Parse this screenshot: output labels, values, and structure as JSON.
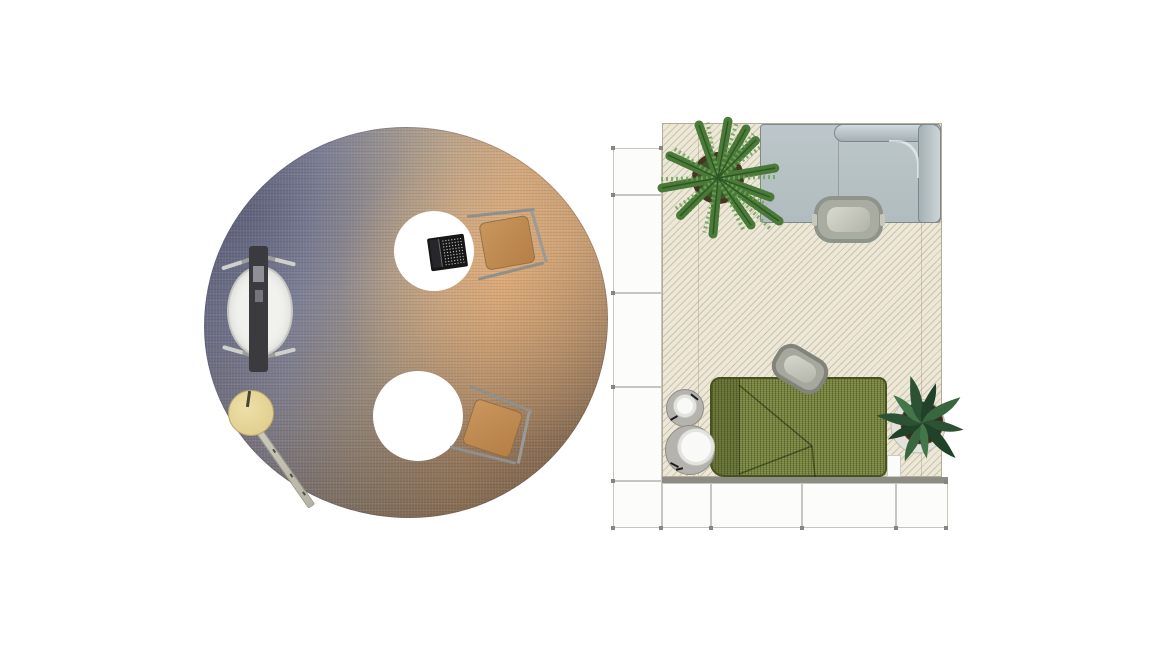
{
  "canvas": {
    "width": 1166,
    "height": 656,
    "background": "#ffffff"
  },
  "scene": {
    "title": "Top-down furniture space plan",
    "zones": [
      {
        "id": "lounge-circle",
        "label": "Round gradient rug lounge setting",
        "rug": {
          "shape": "round",
          "label": "Woven gradient area rug",
          "colors": {
            "slate_blue": "#6a6c83",
            "lavender_gray": "#8f91a4",
            "tan": "#c09a74",
            "orange": "#cda67e",
            "brown": "#6f6156"
          }
        },
        "items": [
          {
            "id": "lounge-chair",
            "label": "High-back lounge chair with privacy panel",
            "panel_color": "#3a3a3f",
            "body_color": "#f1f1ee"
          },
          {
            "id": "round-table-top",
            "label": "Round white table with laptop",
            "color": "#ffffff"
          },
          {
            "id": "laptop",
            "label": "Open laptop",
            "color": "#161616"
          },
          {
            "id": "chair-top",
            "label": "Caramel sled-base side chair",
            "seat_color": "#c29058"
          },
          {
            "id": "round-table-bottom",
            "label": "Round white table",
            "color": "#ffffff"
          },
          {
            "id": "chair-bottom",
            "label": "Caramel sled-base side chair",
            "seat_color": "#c29058"
          },
          {
            "id": "disc-stool",
            "label": "Wooden disc stool with leaning plank",
            "disc_color": "#e7d595",
            "plank_color": "#c8c6b6"
          }
        ]
      },
      {
        "id": "modular-room",
        "label": "Modular lounge room with storage cubes",
        "rug": {
          "shape": "rectangle",
          "label": "Cream diagonal-hatch rug",
          "color": "#ece7d7",
          "hatch_color": "#a69c7c"
        },
        "storage": {
          "label": "White modular storage cubes (left column and bottom row)",
          "cube_color": "#fcfcfa",
          "cap_color": "#8c8c84",
          "column_segments": 5,
          "row_segments": 4
        },
        "items": [
          {
            "id": "sofa-gray",
            "label": "Light gray L-shaped sectional sofa",
            "color": "#b7c2c5",
            "back_color": "#ccd5d7"
          },
          {
            "id": "ottoman-gray",
            "label": "Gray rounded ottoman",
            "color": "#a9aca0"
          },
          {
            "id": "sofa-green",
            "label": "Olive green knit corner sofa",
            "color": "#75813e"
          },
          {
            "id": "ottoman-green",
            "label": "Rotated gray-green ottoman",
            "color": "#a7a89d"
          },
          {
            "id": "side-table-small",
            "label": "Small round side table with cup",
            "color": "#b5b3ae"
          },
          {
            "id": "side-table-large",
            "label": "Round side table with tray",
            "color": "#b5b3ae"
          },
          {
            "id": "fern-plant",
            "label": "Potted fern (top left)",
            "foliage": "#4a7a38",
            "pot": "#453521"
          },
          {
            "id": "tropical-plant",
            "label": "Potted tropical plant (bottom right)",
            "foliage": "#2b5233",
            "pot": "#3a2c1c"
          }
        ]
      }
    ]
  },
  "palette": {
    "fern_green": "#4a7a38",
    "fern_green_dark": "#2e5526",
    "fern_green_light": "#6fa35b",
    "fern_pot": "#453521",
    "fern_soil": "#3a5a2c",
    "trop_green": "#2b5233",
    "trop_green_mid": "#38663f",
    "trop_green_dark": "#1f4228",
    "trop_green_light": "#43774a",
    "trop_pot": "#3a2c1c",
    "trop_saucer": "#e2e2da",
    "seam_olive": "rgba(25,32,8,0.5)"
  }
}
